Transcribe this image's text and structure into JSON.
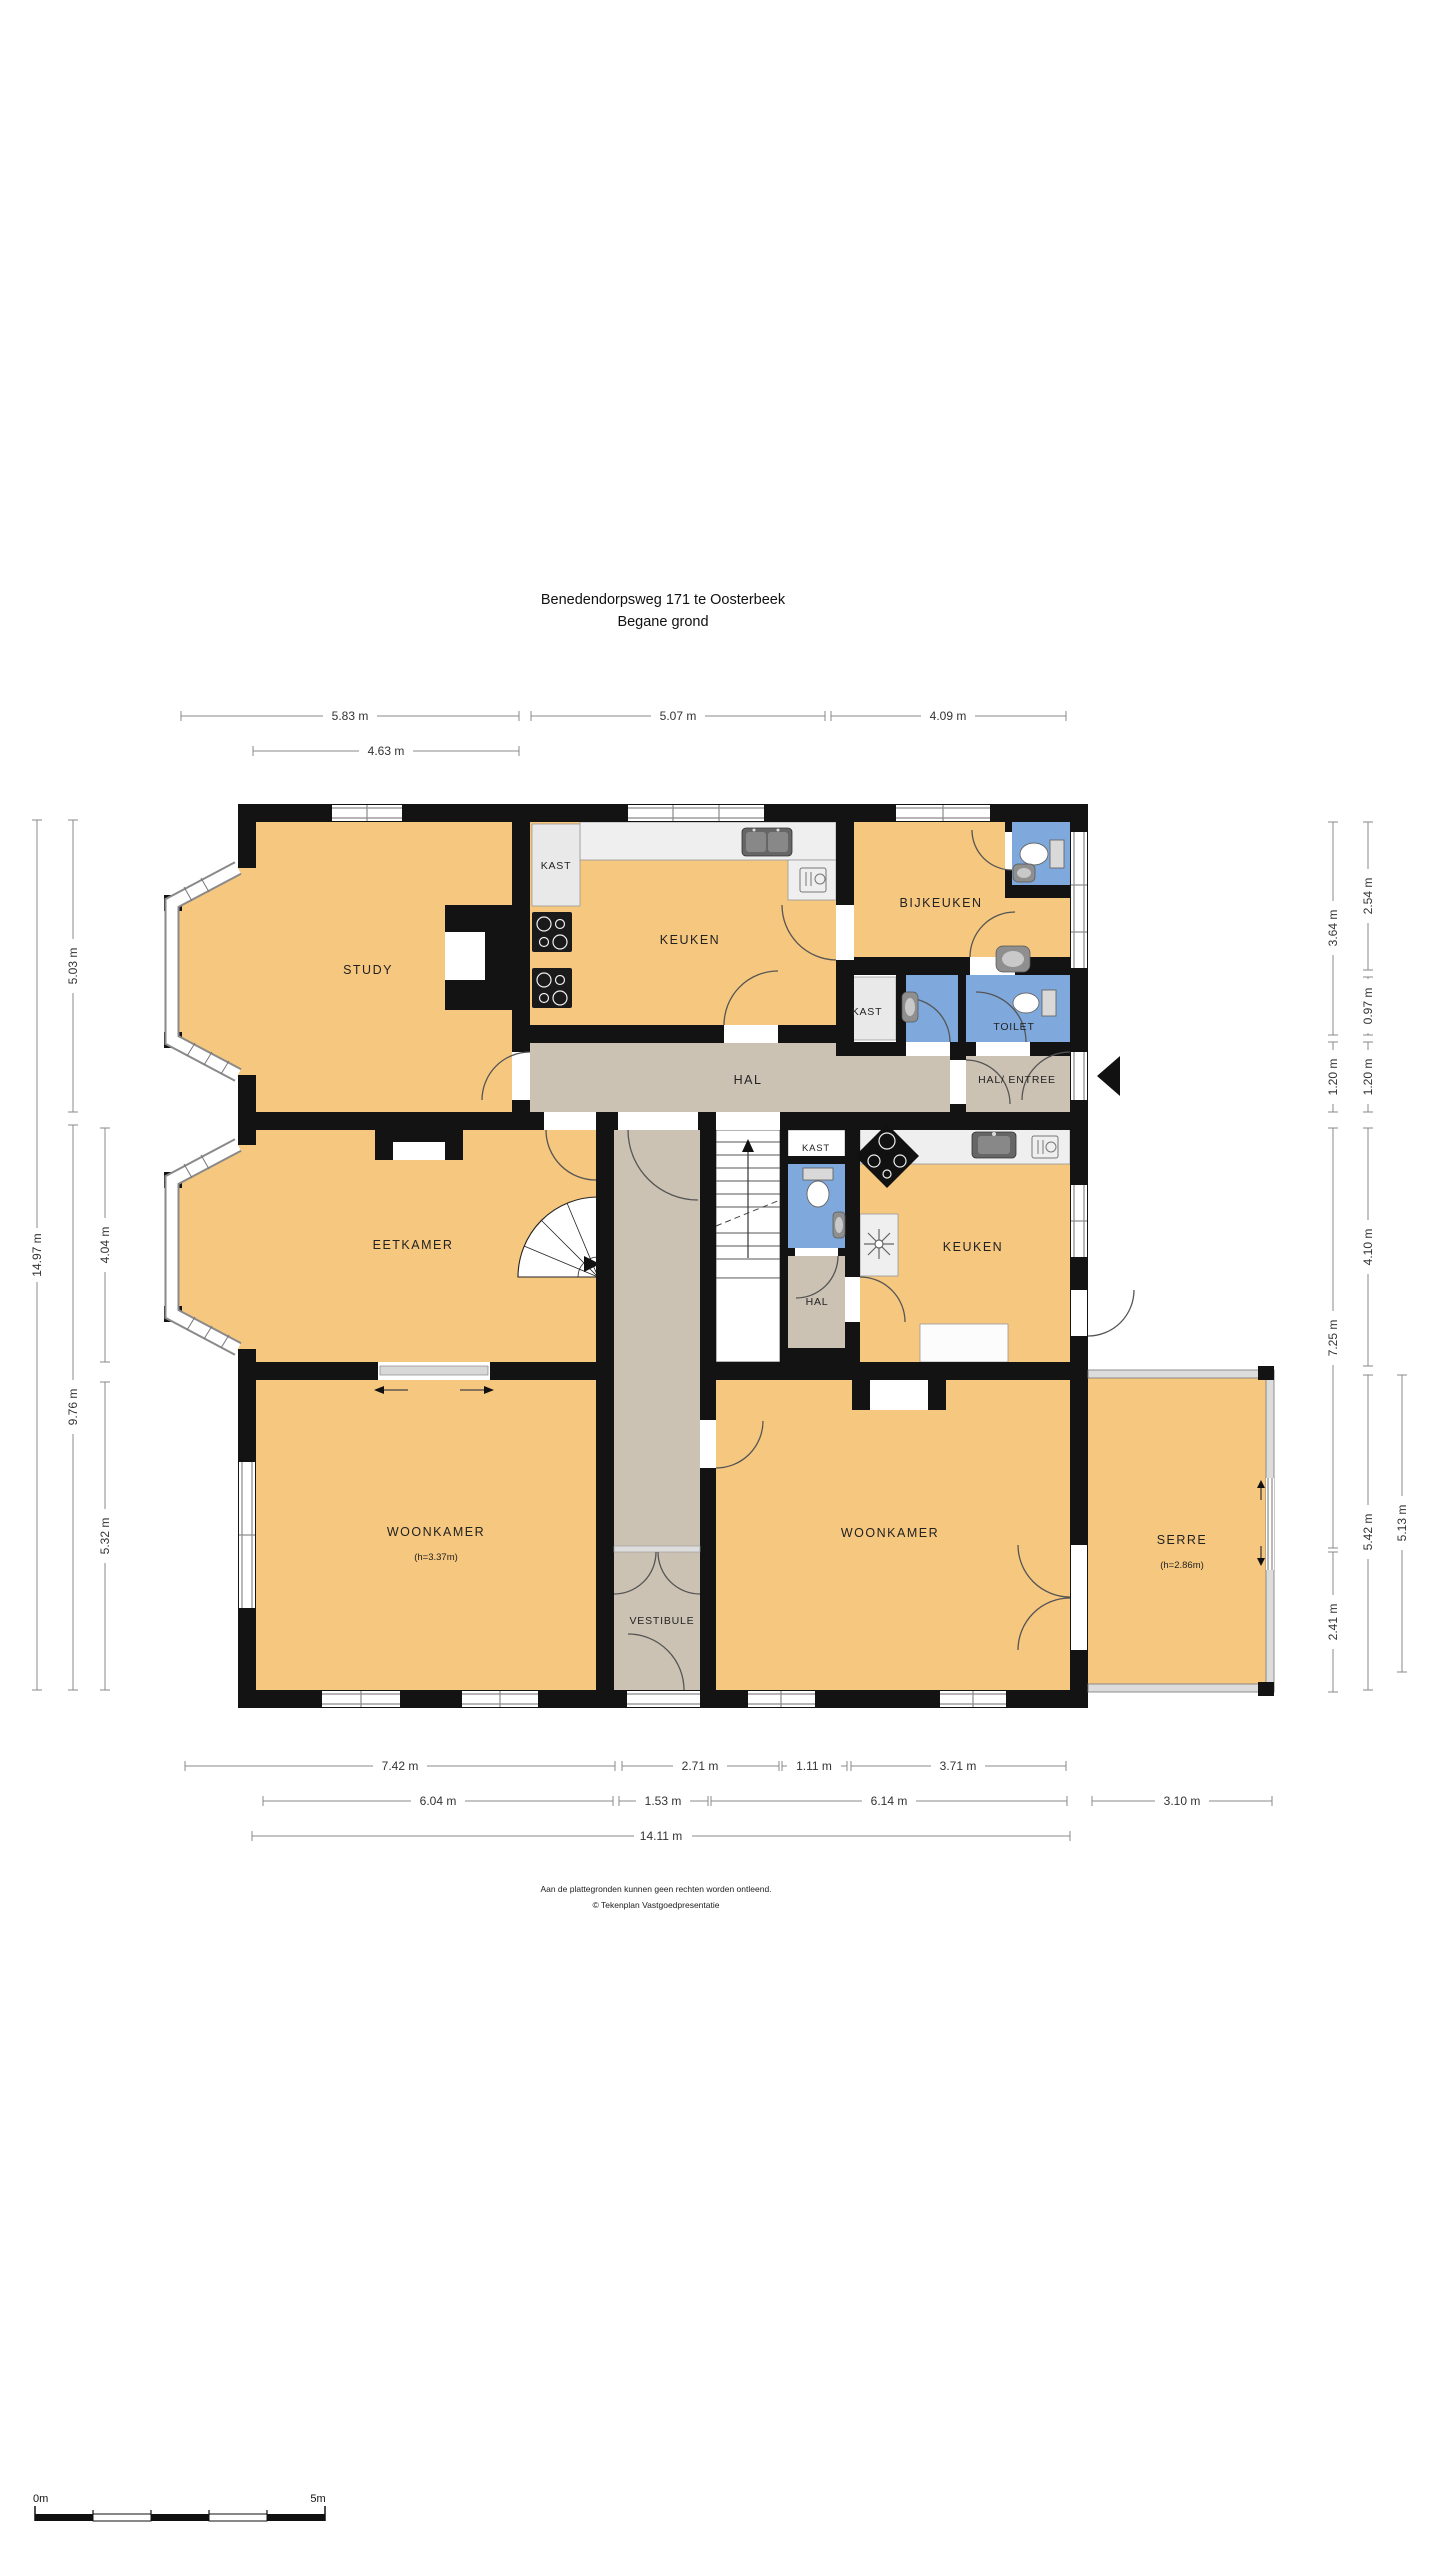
{
  "title": {
    "address": "Benedendorpsweg 171 te Oosterbeek",
    "floor": "Begane grond"
  },
  "rooms": {
    "study": "STUDY",
    "kast_top": "KAST",
    "keuken_top": "KEUKEN",
    "bijkeuken": "BIJKEUKEN",
    "kast_right": "KAST",
    "toilet": "TOILET",
    "hal": "HAL",
    "hal_entree": "HAL/ ENTREE",
    "eetkamer": "EETKAMER",
    "kast_mid": "KAST",
    "hal_small": "HAL",
    "keuken_mid": "KEUKEN",
    "woonkamer_left": "WOONKAMER",
    "woonkamer_left_height": "(h=3.37m)",
    "vestibule": "VESTIBULE",
    "woonkamer_right": "WOONKAMER",
    "serre": "SERRE",
    "serre_height": "(h=2.86m)"
  },
  "dimensions": {
    "top": [
      "5.83 m",
      "5.07 m",
      "4.09 m"
    ],
    "top2": [
      "4.63 m"
    ],
    "left": [
      "14.97 m",
      "5.03 m",
      "9.76 m",
      "4.04 m",
      "5.32 m"
    ],
    "right": [
      "3.64 m",
      "1.20 m",
      "7.25 m",
      "2.41 m",
      "2.54 m",
      "0.97 m",
      "1.20 m",
      "4.10 m",
      "5.42 m",
      "5.13 m"
    ],
    "bottom": [
      "7.42 m",
      "2.71 m",
      "1.11 m",
      "3.71 m"
    ],
    "bottom2": [
      "6.04 m",
      "1.53 m",
      "6.14 m",
      "3.10 m"
    ],
    "bottom3": [
      "14.11 m"
    ]
  },
  "footer": {
    "disclaimer": "Aan de plattegronden kunnen geen rechten worden ontleend.",
    "copyright": "© Tekenplan Vastgoedpresentatie"
  },
  "scale_bar": {
    "start": "0m",
    "end": "5m"
  },
  "colors": {
    "room_fill": "#F6C77F",
    "hall_fill": "#CBC2B3",
    "wet_room_fill": "#7FA9DC",
    "wall": "#131313",
    "counter_fill": "#EFEFEF"
  }
}
